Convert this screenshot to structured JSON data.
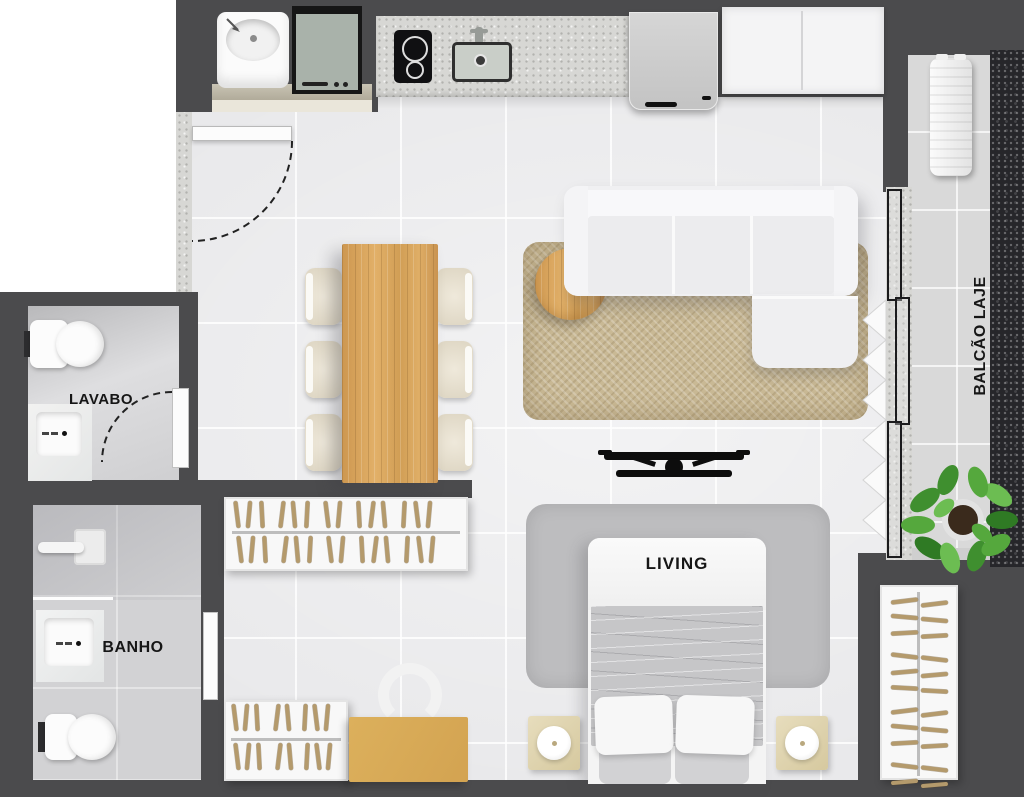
{
  "labels": {
    "lavabo": "LAVABO",
    "banho": "BANHO",
    "living": "LIVING",
    "balcao_line1": "BALCÃO LAJE",
    "balcao_line2": "TÉCNICA"
  },
  "colors": {
    "wall": "#4b4b4d",
    "floor": "#e9e9eb",
    "wet_floor": "#d2d2d4",
    "balcony_floor": "#d9d9d9",
    "granite": "#26262a",
    "counter": "#d7d7d4",
    "wood": "#d8a057",
    "desk": "#d3a351",
    "rug_living": "#c9b995",
    "rug_bed": "#bdbdbf",
    "nightstand": "#d6c99f",
    "hanger": "#b49a6c",
    "washer": "#a9b2aa",
    "plant": "#4f9b38",
    "label": "#161616"
  }
}
